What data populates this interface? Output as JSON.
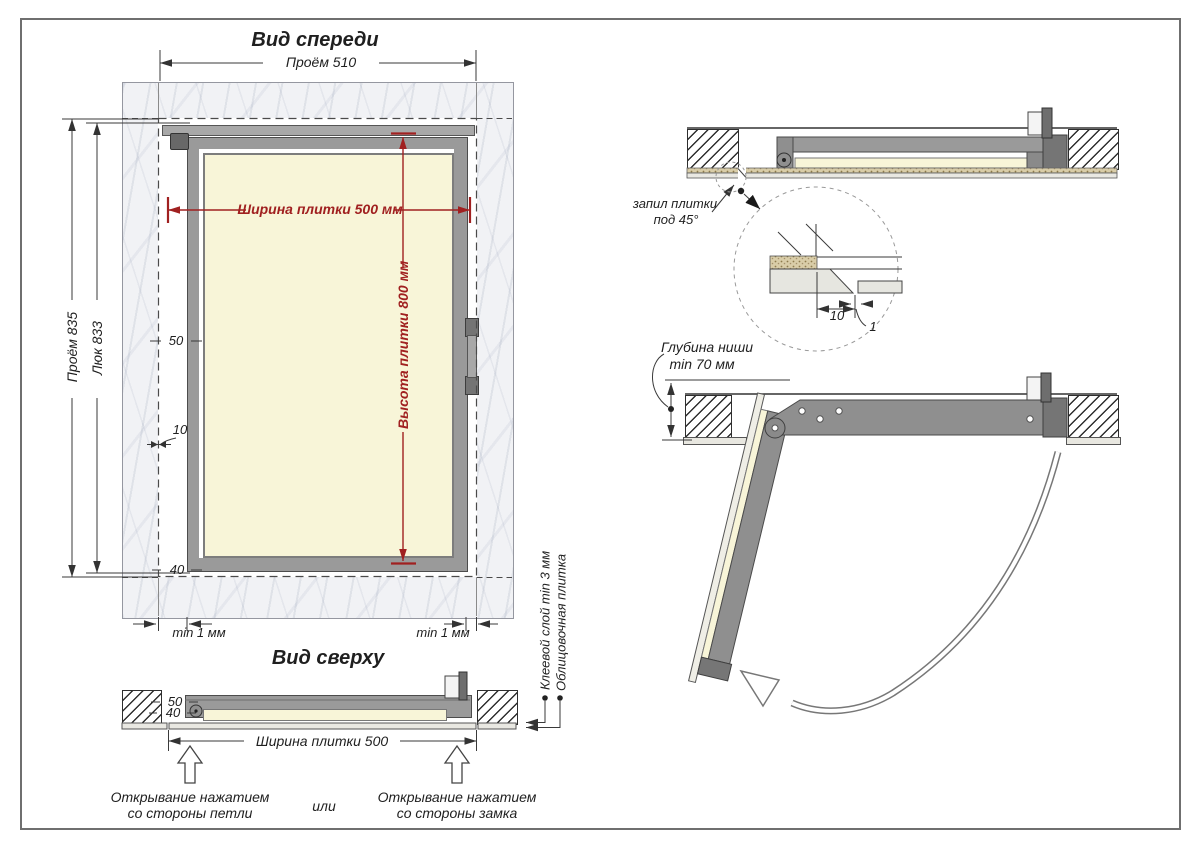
{
  "front_view": {
    "title": "Вид спереди",
    "dims": {
      "opening_width": "Проём 510",
      "opening_height": "Проём 835",
      "hatch_height": "Люк 833",
      "tile_width": "Ширина плитки 500 мм",
      "tile_height": "Высота плитки 800 мм",
      "offset_50": "50",
      "offset_10": "10",
      "offset_40": "40",
      "gap_left": "min 1 мм",
      "gap_right": "min 1 мм"
    }
  },
  "top_view": {
    "title": "Вид сверху",
    "dims": {
      "offset_50": "50",
      "offset_40": "40",
      "tile_width": "Ширина плитки 500"
    },
    "callouts": {
      "adhesive": "Клеевой слой min 3 мм",
      "tile": "Облицовочная плитка"
    },
    "opening": {
      "hinge_side_line1": "Открывание нажатием",
      "hinge_side_line2": "со стороны петли",
      "or": "или",
      "lock_side_line1": "Открывание нажатием",
      "lock_side_line2": "со стороны замка"
    }
  },
  "sections": {
    "closed": {
      "cut_label_line1": "запил плитки",
      "cut_label_line2": "под 45°",
      "detail_offset": "10",
      "detail_gap": "1"
    },
    "open": {
      "depth_line1": "Глубина ниши",
      "depth_line2": "min 70 мм"
    }
  },
  "colors": {
    "dimension_red": "#a02020",
    "frame_gray": "#9a9a9a",
    "tile_cream": "#f8f5d8",
    "line_dark": "#3a3a3a"
  }
}
